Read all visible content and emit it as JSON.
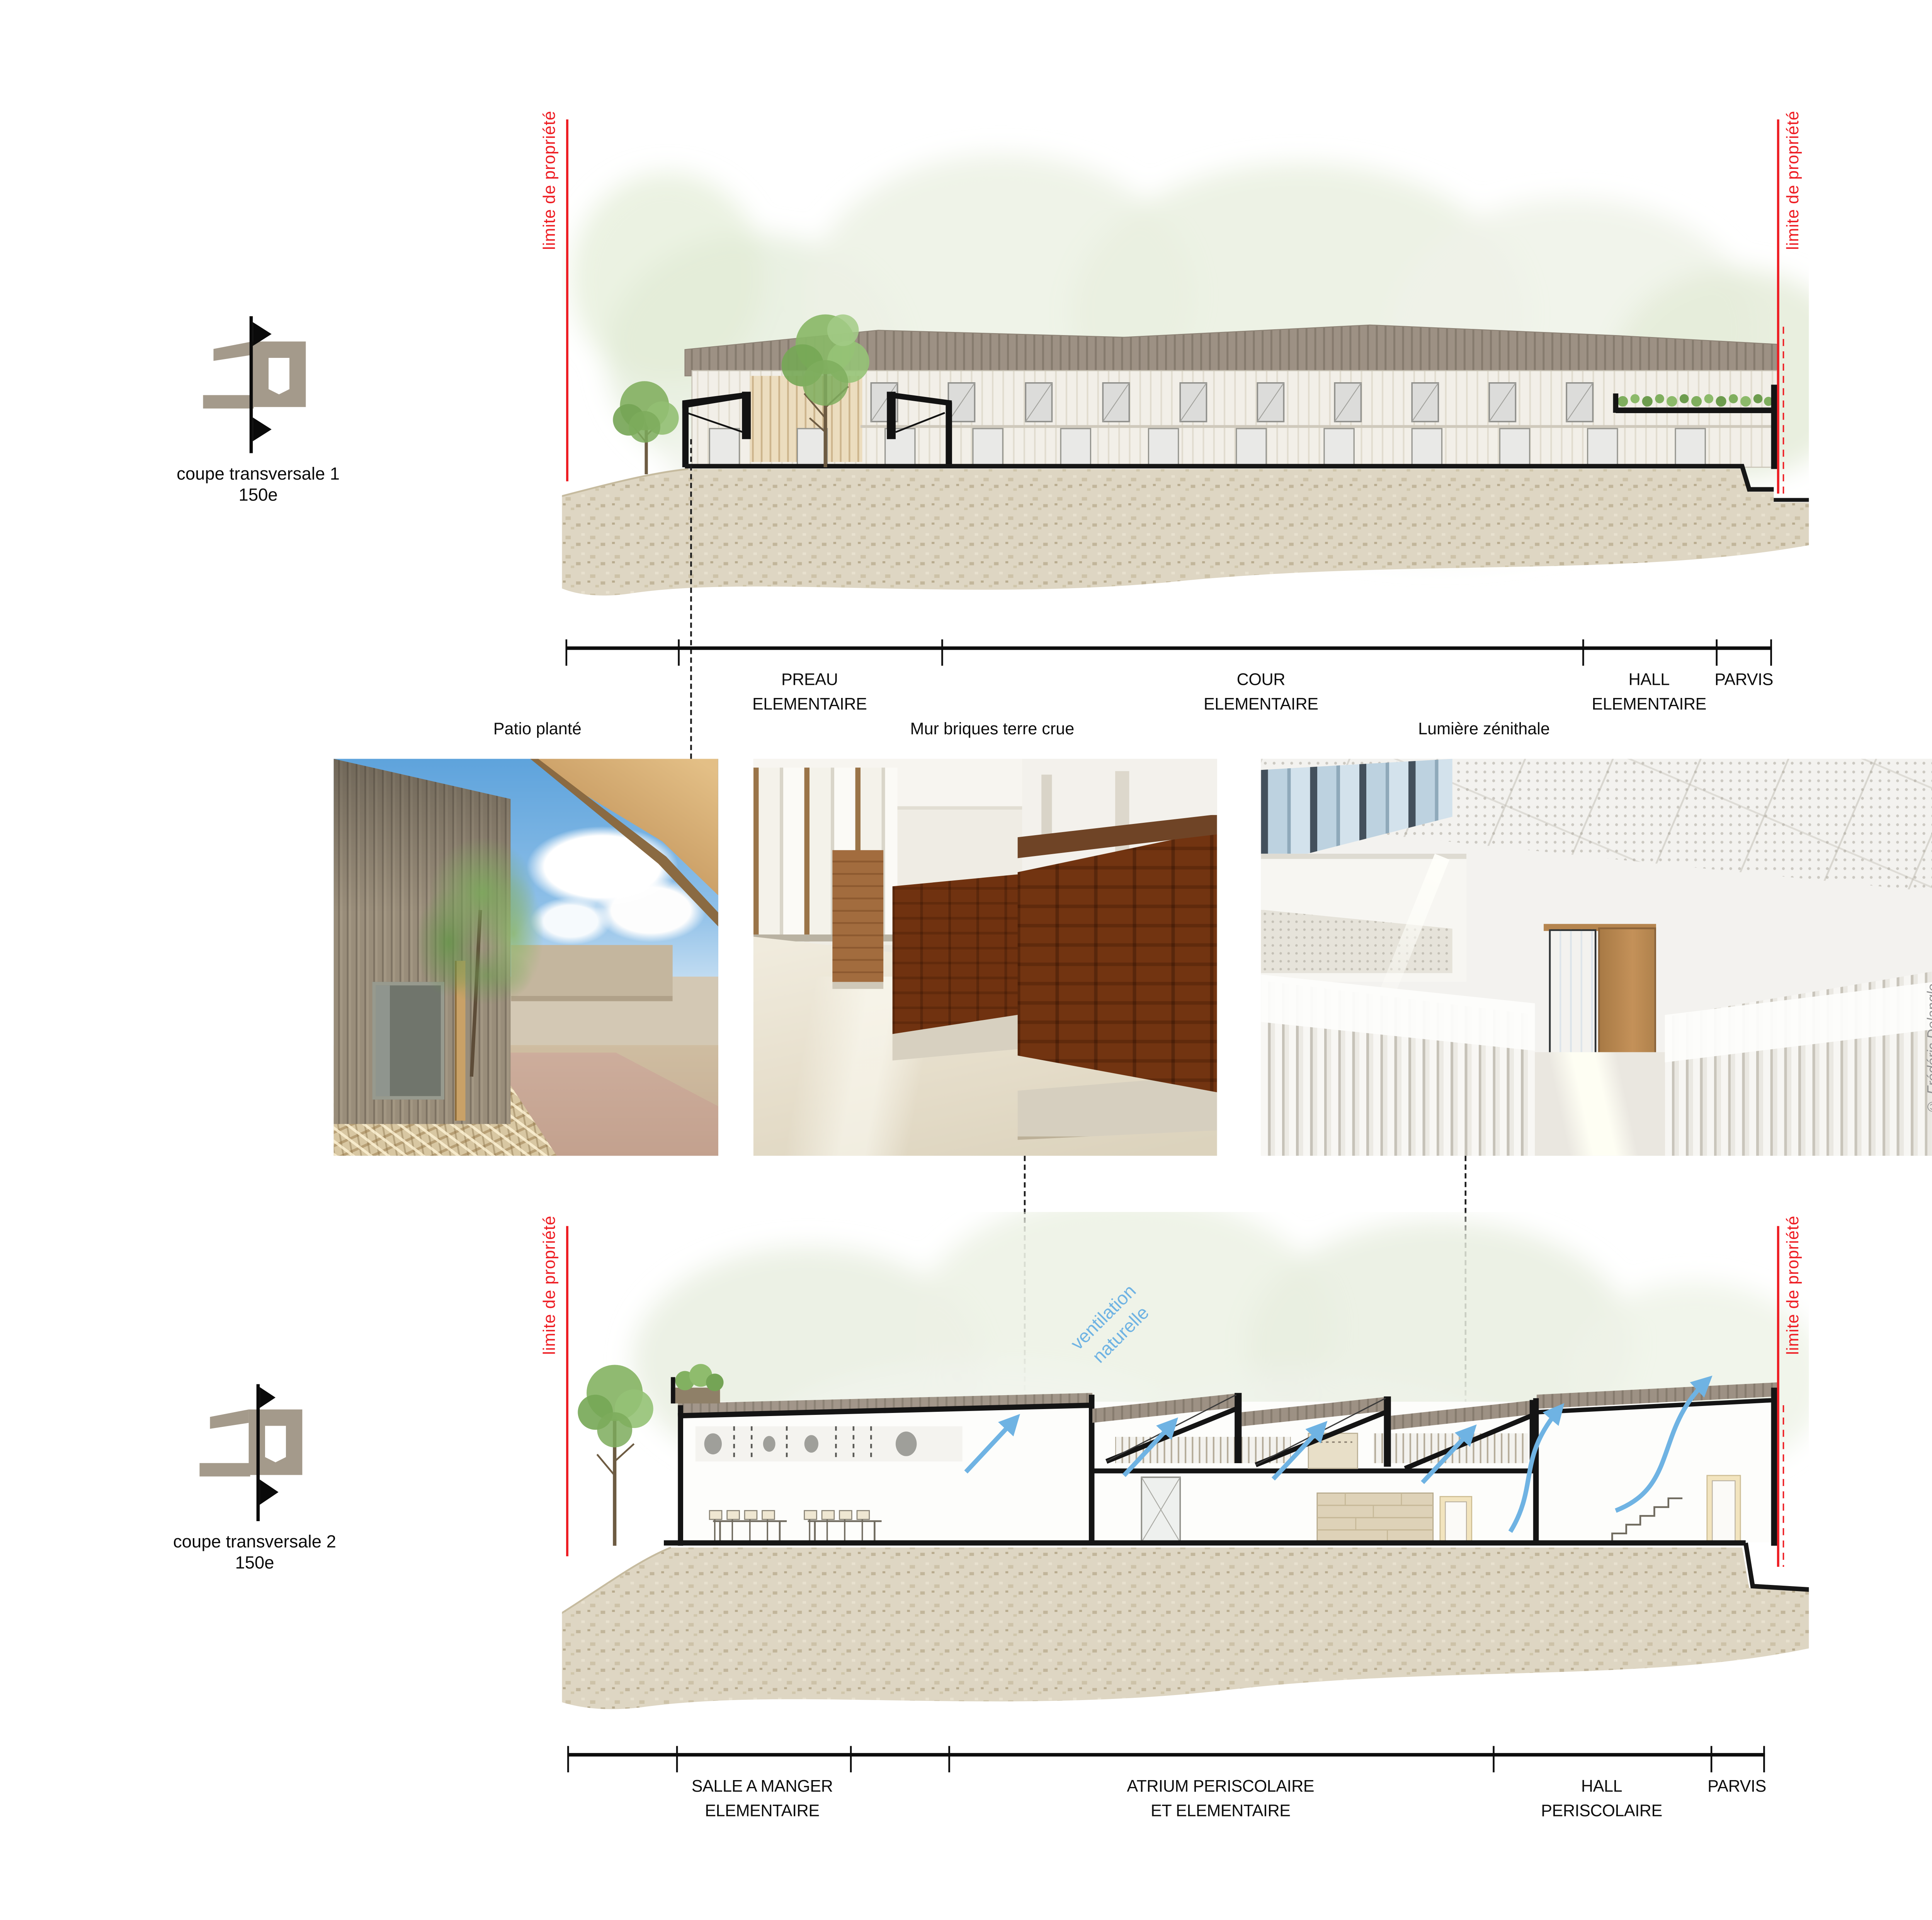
{
  "key_plans": [
    {
      "label": "coupe transversale 1",
      "scale": "150e"
    },
    {
      "label": "coupe transversale 2",
      "scale": "150e"
    }
  ],
  "sections": {
    "coupe1": {
      "property_limit": "limite de propriété",
      "dim_segments": [
        {
          "label": "PREAU\nELEMENTAIRE"
        },
        {
          "label": "COUR\nELEMENTAIRE"
        },
        {
          "label": "HALL\nELEMENTAIRE"
        },
        {
          "label": "PARVIS"
        }
      ]
    },
    "coupe2": {
      "property_limit": "limite de propriété",
      "annotation_ventilation": "ventilation\nnaturelle",
      "dim_segments": [
        {
          "label": "SALLE A MANGER\nELEMENTAIRE"
        },
        {
          "label": "ATRIUM PERISCOLAIRE\nET ELEMENTAIRE"
        },
        {
          "label": "HALL\nPERISCOLAIRE"
        },
        {
          "label": "PARVIS"
        }
      ]
    }
  },
  "photos": [
    {
      "caption": "Patio planté"
    },
    {
      "caption": "Mur briques terre crue"
    },
    {
      "caption": "Lumière zénithale",
      "credit": "© Frédéric Delangle"
    }
  ],
  "materials": [
    {
      "caption": "STRUCTURE BOIS"
    },
    {
      "caption": "BARDAGE BOIS"
    },
    {
      "caption": "CLOISONS EN BRIQUES DE TERRE CRUE"
    },
    {
      "caption": "FAUX PLAFONDS EN FIBRE DE BOIS"
    }
  ],
  "colors": {
    "property_line_red": "#ee1d23",
    "ventilation_blue": "#6fb3e3",
    "keyplan_taupe": "#a49a8b",
    "drawing_black": "#141414",
    "roof_taupe": "#9d9184",
    "facade_cream": "#f2efe8",
    "terrain_beige": "#ded6c3",
    "foliage_pale": "#eaf0e2",
    "tree_green": "#84b163",
    "brick_terracotta": "#a8713f",
    "wood_light": "#c59659"
  }
}
